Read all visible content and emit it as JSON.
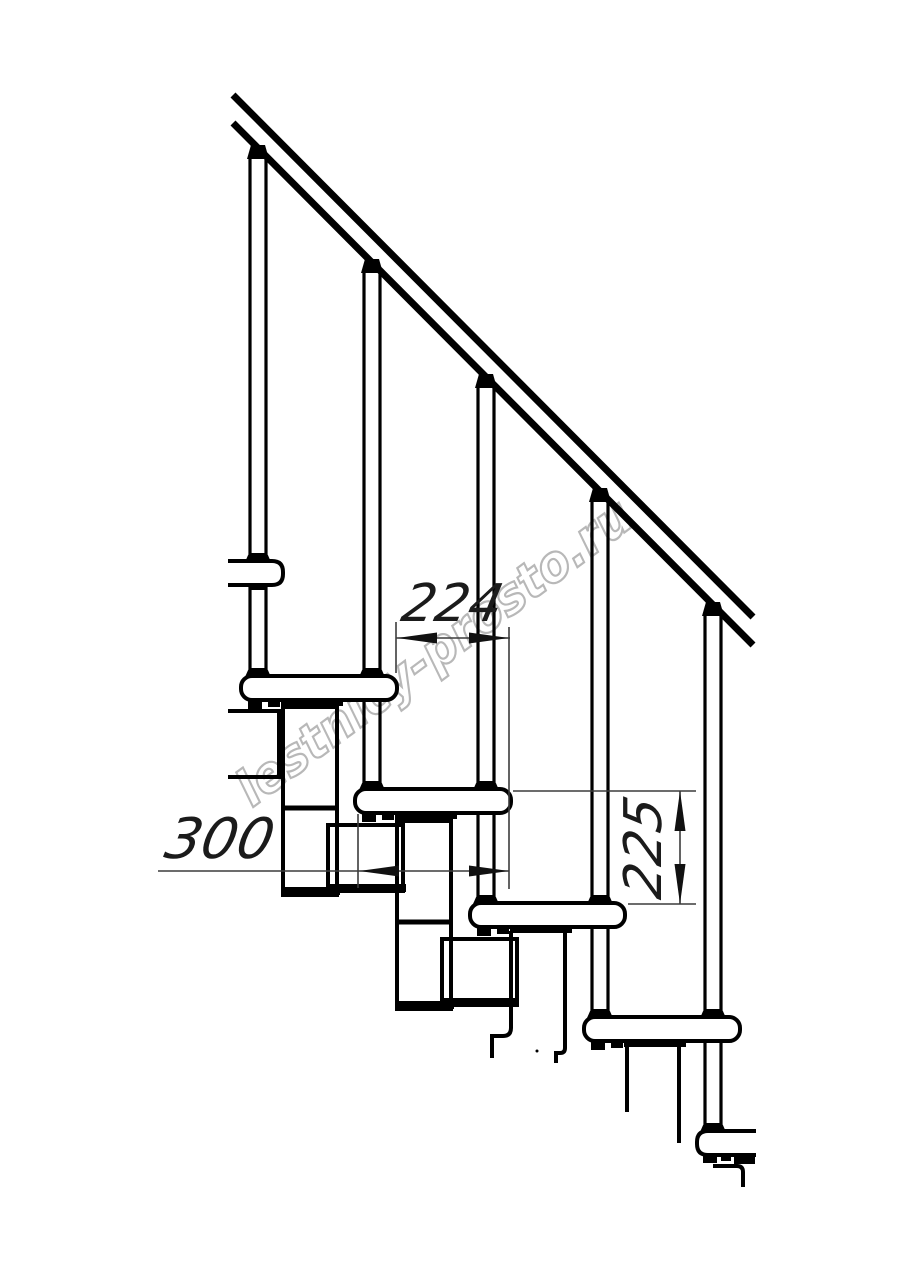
{
  "watermark": {
    "text": "lestnicy-prosto.ru",
    "color": "#b8b8b8"
  },
  "drawing": {
    "ink_color": "#000000",
    "dim_color": "#3c3c3c",
    "labels": {
      "step_going": "224",
      "tread_depth": "300",
      "step_rise": "225"
    }
  }
}
